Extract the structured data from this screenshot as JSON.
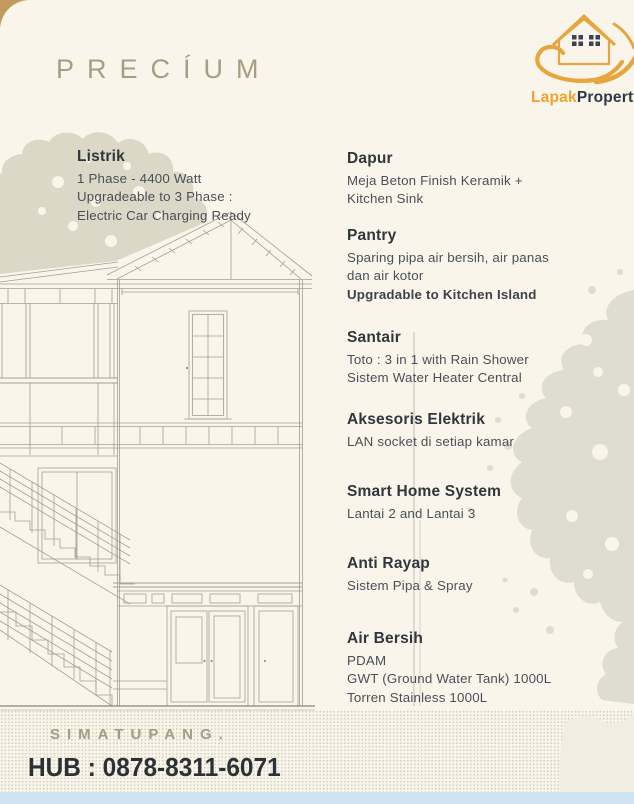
{
  "page": {
    "title": "PRECÍUM"
  },
  "logo": {
    "icon": "hand-holding-house-icon",
    "brand_first": "Lapak",
    "brand_second": "Property"
  },
  "features": [
    {
      "title": "Listrik",
      "lines": [
        "1 Phase - 4400 Watt",
        "Upgradeable to 3 Phase :",
        "Electric Car Charging Ready"
      ]
    },
    {
      "title": "Dapur",
      "lines": [
        "Meja Beton Finish Keramik +",
        "Kitchen Sink"
      ]
    },
    {
      "title": "Pantry",
      "lines": [
        "Sparing pipa air bersih, air panas",
        "dan air kotor",
        "Upgradable to Kitchen Island"
      ]
    },
    {
      "title": "Santair",
      "lines": [
        "Toto : 3 in 1 with Rain Shower",
        "Sistem Water Heater Central"
      ]
    },
    {
      "title": "Aksesoris Elektrik",
      "lines": [
        "LAN socket di setiap kamar"
      ]
    },
    {
      "title": "Smart Home System",
      "lines": [
        "Lantai 2 and Lantai 3"
      ]
    },
    {
      "title": "Anti Rayap",
      "lines": [
        "Sistem Pipa & Spray"
      ]
    },
    {
      "title": "Air Bersih",
      "lines": [
        "PDAM",
        "GWT (Ground Water Tank) 1000L",
        "Torren Stainless 1000L"
      ]
    }
  ],
  "footer": {
    "location": "SIMATUPANG.",
    "contact": "HUB : 0878-8311-6071"
  },
  "colors": {
    "accent_gold": "#EFA42F",
    "brand_dark": "#2C3848",
    "title_taupe": "#A79D83",
    "text_dark": "#31363D",
    "sheet_cream": "#FAF5EB",
    "corner_tan": "#C29A5E",
    "bottom_strip_blue": "#CDE3F1"
  }
}
